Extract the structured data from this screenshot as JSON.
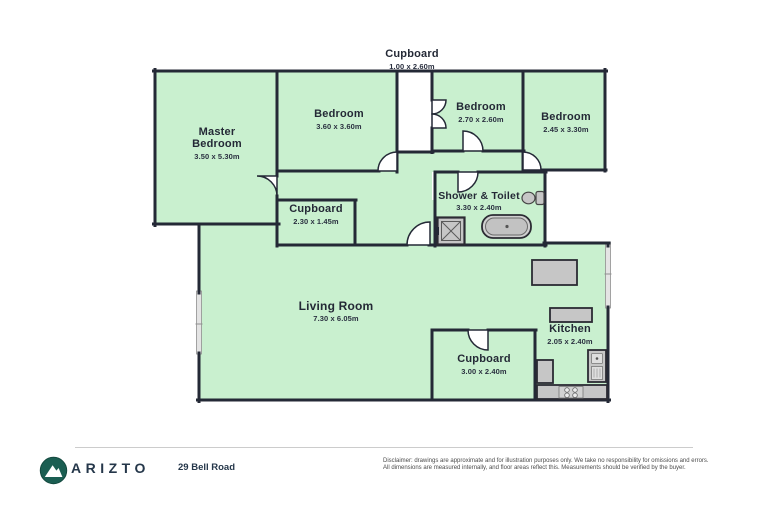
{
  "plan": {
    "rooms": [
      {
        "name": "Cupboard",
        "dims": "1.00 x 2.60m"
      },
      {
        "name": "Master Bedroom",
        "dims": "3.50 x 5.30m"
      },
      {
        "name": "Bedroom",
        "dims": "3.60 x 3.60m"
      },
      {
        "name": "Bedroom",
        "dims": "2.70 x 2.60m"
      },
      {
        "name": "Bedroom",
        "dims": "2.45 x 3.30m"
      },
      {
        "name": "Shower & Toilet",
        "dims": "3.30 x 2.40m"
      },
      {
        "name": "Cupboard",
        "dims": "2.30 x 1.45m"
      },
      {
        "name": "Living Room",
        "dims": "7.30 x 6.05m"
      },
      {
        "name": "Cupboard",
        "dims": "3.00 x 2.40m"
      },
      {
        "name": "Kitchen",
        "dims": "2.05 x 2.40m"
      }
    ],
    "colors": {
      "floor_fill": "#c9f0cf",
      "wall": "#242936",
      "fixture_fill": "#c6c6c6",
      "window_fill": "#e4e4e4"
    }
  },
  "footer": {
    "brand": "ARIZTO",
    "address": "29 Bell Road",
    "disclaimer_line1": "Disclaimer: drawings are approximate and for illustration purposes only. We take no responsibility for omissions and errors.",
    "disclaimer_line2": "All dimensions are measured internally, and floor areas reflect this. Measurements should be verified by the buyer."
  }
}
